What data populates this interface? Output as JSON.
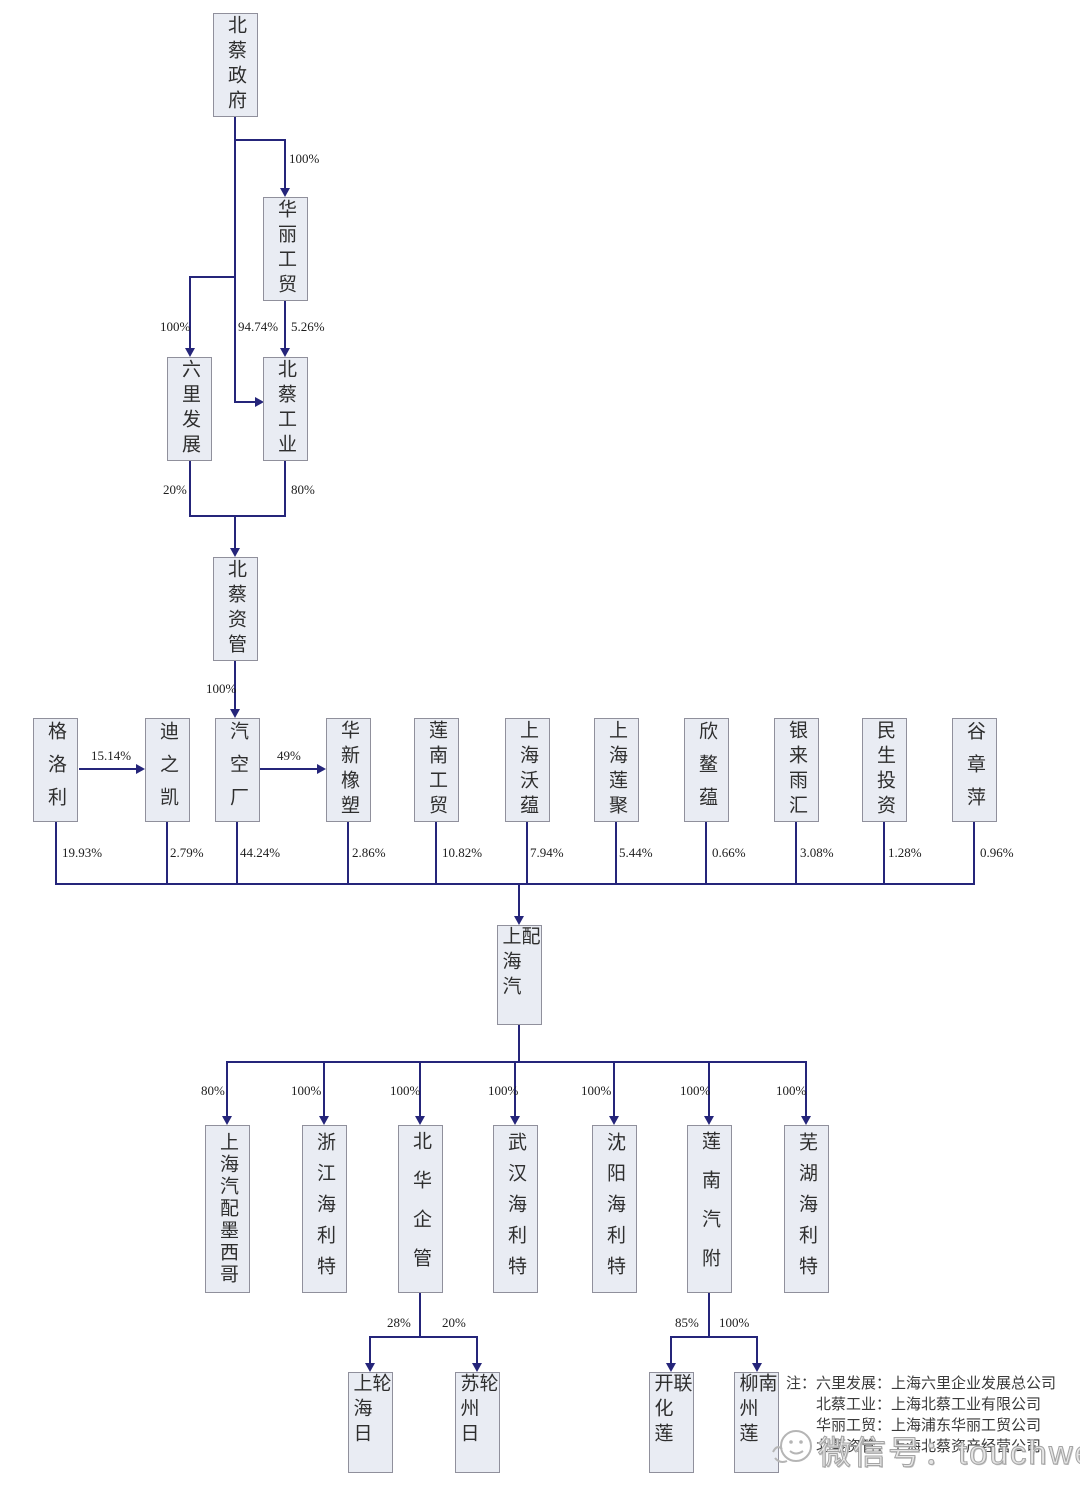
{
  "diagram_title": "equity-structure-chart",
  "colors": {
    "line": "#25257a",
    "box_fill": "#e9ecf3",
    "box_border": "#90909c"
  },
  "nodes": [
    {
      "id": "beicai-gov",
      "label": "北蔡政府"
    },
    {
      "id": "huali-gongmao",
      "label": "华丽工贸"
    },
    {
      "id": "liuli-fazhan",
      "label": "六里发展"
    },
    {
      "id": "beicai-gongye",
      "label": "北蔡工业"
    },
    {
      "id": "beicai-ziguan",
      "label": "北蔡资管"
    },
    {
      "id": "geluoli",
      "label": "格洛利"
    },
    {
      "id": "dizhikai",
      "label": "迪之凯"
    },
    {
      "id": "qikongchang",
      "label": "汽空厂"
    },
    {
      "id": "huaxin-xiangsu",
      "label": "华新橡塑"
    },
    {
      "id": "liannan-gongmao",
      "label": "莲南工贸"
    },
    {
      "id": "shanghai-woyun",
      "label": "上海沃蕴"
    },
    {
      "id": "shanghai-lianju",
      "label": "上海莲聚"
    },
    {
      "id": "xinaoyun",
      "label": "欣鳌蕴"
    },
    {
      "id": "yinlai-yuhui",
      "label": "银来雨汇"
    },
    {
      "id": "minsheng-touzi",
      "label": "民生投资"
    },
    {
      "id": "gu-zhangping",
      "label": "谷章萍"
    },
    {
      "id": "shanghai-qipei",
      "label": "上海汽配"
    },
    {
      "id": "sh-qipei-mexico",
      "label": "上海汽配墨西哥"
    },
    {
      "id": "zhejiang-hailite",
      "label": "浙江海利特"
    },
    {
      "id": "beihua-qiguan",
      "label": "北华企管"
    },
    {
      "id": "wuhan-hailite",
      "label": "武汉海利特"
    },
    {
      "id": "shenyang-hailite",
      "label": "沈阳海利特"
    },
    {
      "id": "liannan-qifu",
      "label": "莲南汽附"
    },
    {
      "id": "wuhu-hailite",
      "label": "芜湖海利特"
    },
    {
      "id": "shanghai-rilun",
      "label": "上海日轮"
    },
    {
      "id": "suzhou-rilun",
      "label": "苏州日轮"
    },
    {
      "id": "kaihua-lianlian",
      "label": "开化莲联"
    },
    {
      "id": "liuzhou-liannan",
      "label": "柳州莲南"
    }
  ],
  "edges": [
    {
      "from": "北蔡政府",
      "to": "华丽工贸",
      "label": "100%"
    },
    {
      "from": "北蔡政府",
      "to": "六里发展",
      "label": "100%"
    },
    {
      "from": "北蔡政府",
      "to": "北蔡工业",
      "label": "94.74%"
    },
    {
      "from": "华丽工贸",
      "to": "北蔡工业",
      "label": "5.26%"
    },
    {
      "from": "六里发展",
      "to": "北蔡资管",
      "label": "20%"
    },
    {
      "from": "北蔡工业",
      "to": "北蔡资管",
      "label": "80%"
    },
    {
      "from": "北蔡资管",
      "to": "汽空厂",
      "label": "100%"
    },
    {
      "from": "格洛利",
      "to": "迪之凯",
      "label": "15.14%"
    },
    {
      "from": "汽空厂",
      "to": "华新橡塑",
      "label": "49%"
    },
    {
      "from": "格洛利",
      "to": "上海汽配",
      "label": "19.93%"
    },
    {
      "from": "迪之凯",
      "to": "上海汽配",
      "label": "2.79%"
    },
    {
      "from": "汽空厂",
      "to": "上海汽配",
      "label": "44.24%"
    },
    {
      "from": "华新橡塑",
      "to": "上海汽配",
      "label": "2.86%"
    },
    {
      "from": "莲南工贸",
      "to": "上海汽配",
      "label": "10.82%"
    },
    {
      "from": "上海沃蕴",
      "to": "上海汽配",
      "label": "7.94%"
    },
    {
      "from": "上海莲聚",
      "to": "上海汽配",
      "label": "5.44%"
    },
    {
      "from": "欣鳌蕴",
      "to": "上海汽配",
      "label": "0.66%"
    },
    {
      "from": "银来雨汇",
      "to": "上海汽配",
      "label": "3.08%"
    },
    {
      "from": "民生投资",
      "to": "上海汽配",
      "label": "1.28%"
    },
    {
      "from": "谷章萍",
      "to": "上海汽配",
      "label": "0.96%"
    },
    {
      "from": "上海汽配",
      "to": "上海汽配墨西哥",
      "label": "80%"
    },
    {
      "from": "上海汽配",
      "to": "浙江海利特",
      "label": "100%"
    },
    {
      "from": "上海汽配",
      "to": "北华企管",
      "label": "100%"
    },
    {
      "from": "上海汽配",
      "to": "武汉海利特",
      "label": "100%"
    },
    {
      "from": "上海汽配",
      "to": "沈阳海利特",
      "label": "100%"
    },
    {
      "from": "上海汽配",
      "to": "莲南汽附",
      "label": "100%"
    },
    {
      "from": "上海汽配",
      "to": "芜湖海利特",
      "label": "100%"
    },
    {
      "from": "北华企管",
      "to": "上海日轮",
      "label": "28%"
    },
    {
      "from": "北华企管",
      "to": "苏州日轮",
      "label": "20%"
    },
    {
      "from": "莲南汽附",
      "to": "开化莲联",
      "label": "85%"
    },
    {
      "from": "莲南汽附",
      "to": "柳州莲南",
      "label": "100%"
    }
  ],
  "notes": {
    "prefix": "注：",
    "lines": [
      "六里发展：上海六里企业发展总公司",
      "北蔡工业：上海北蔡工业有限公司",
      "华丽工贸：上海浦东华丽工贸公司",
      "北蔡资管：上海北蔡资产经营公司"
    ]
  },
  "watermark": {
    "text": "微信号：touchweb",
    "icon": "wechat-doodle"
  }
}
